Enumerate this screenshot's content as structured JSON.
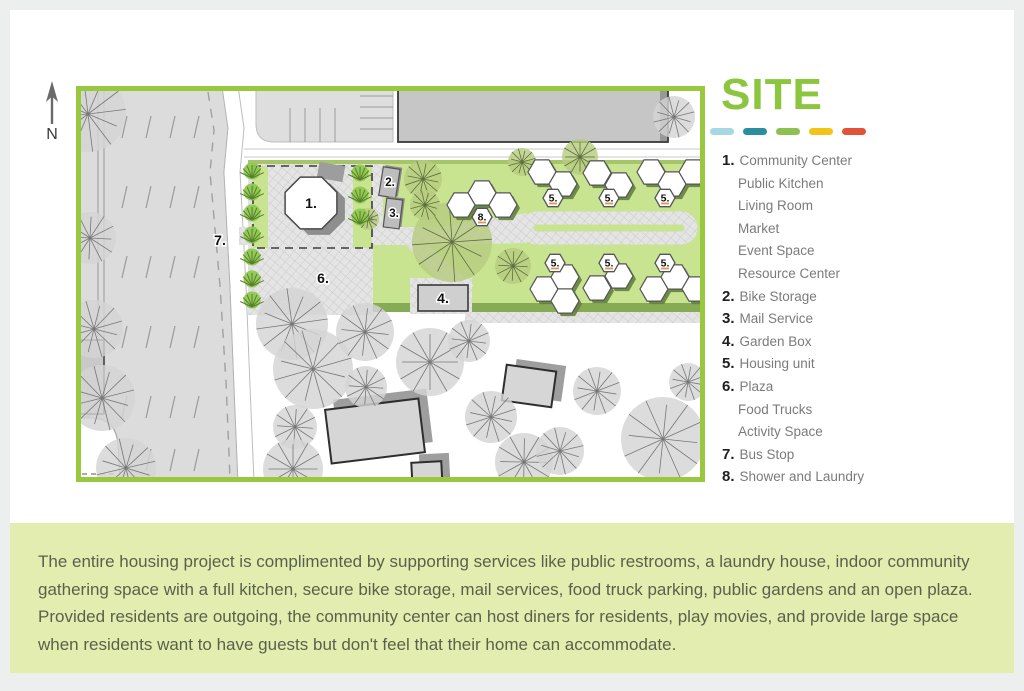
{
  "page": {
    "background": "#edefee",
    "card_bg": "#ffffff"
  },
  "site_plan": {
    "north_label": "N",
    "border_color": "#97c83e",
    "lawn_color": "#c8e491",
    "markers": {
      "community_center": "1.",
      "bike_storage": "2.",
      "mail_service": "3.",
      "garden_box": "4.",
      "housing_unit": "5.",
      "plaza": "6.",
      "bus_stop": "7.",
      "shower_laundry": "8."
    }
  },
  "legend": {
    "title": "SITE",
    "title_color": "#8cc63f",
    "swatches": [
      "#a5d8e2",
      "#2a8f9c",
      "#8cc152",
      "#f3c317",
      "#e15339"
    ],
    "items": [
      {
        "number": "1.",
        "label": "Community Center",
        "sub": [
          "Public Kitchen",
          "Living Room",
          "Market",
          "Event Space",
          "Resource Center"
        ]
      },
      {
        "number": "2.",
        "label": "Bike Storage"
      },
      {
        "number": "3.",
        "label": "Mail Service"
      },
      {
        "number": "4.",
        "label": "Garden Box"
      },
      {
        "number": "5.",
        "label": "Housing unit"
      },
      {
        "number": "6.",
        "label": "Plaza",
        "sub": [
          "Food Trucks",
          "Activity Space"
        ]
      },
      {
        "number": "7.",
        "label": "Bus Stop"
      },
      {
        "number": "8.",
        "label": "Shower and Laundry"
      }
    ]
  },
  "description": {
    "panel_color": "#e4edb0",
    "text": "The entire housing project is complimented by supporting services like public restrooms, a laundry house, indoor community gathering space with a full kitchen, secure bike storage, mail services, food truck parking, public gardens and an open plaza. Provided residents are outgoing, the community center can host diners for residents, play movies, and provide large space when residents want to have guests but don't feel that their home can accommodate."
  }
}
